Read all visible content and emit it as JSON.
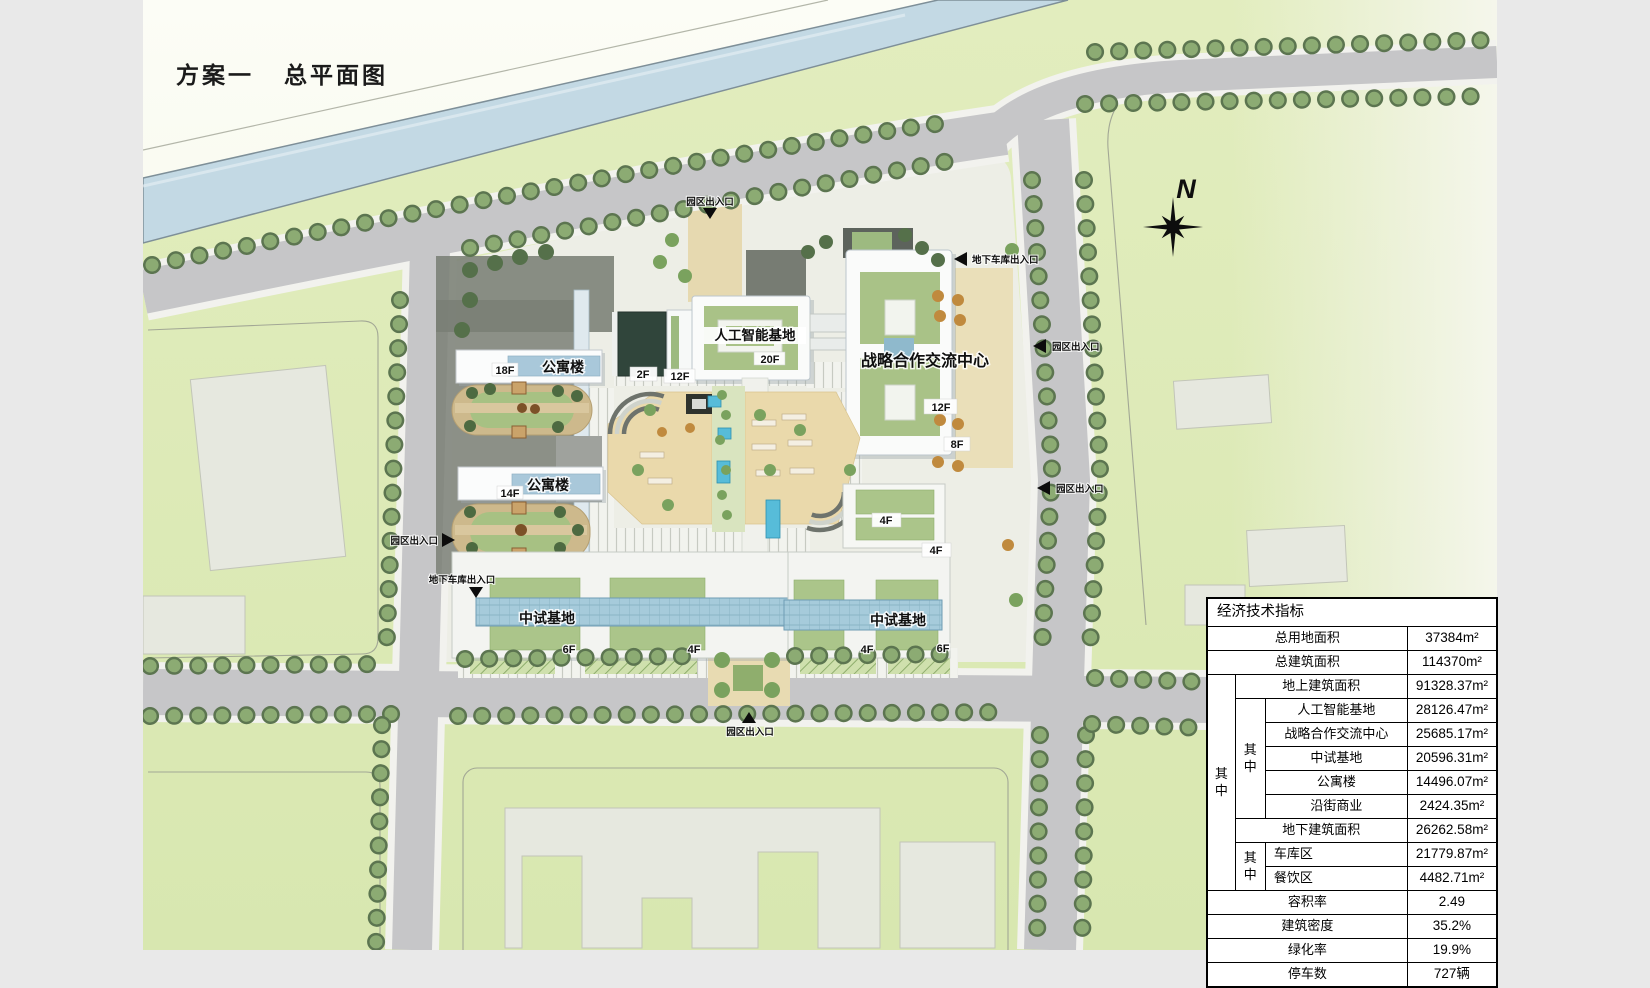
{
  "page": {
    "title1": "方案一",
    "title2": "总平面图"
  },
  "north": {
    "label": "N"
  },
  "plan": {
    "buildings": {
      "apt1": {
        "name": "公寓楼",
        "floors": "18F"
      },
      "apt2": {
        "name": "公寓楼",
        "floors": "14F"
      },
      "podium2f": {
        "floors": "2F"
      },
      "tower12f": {
        "floors": "12F"
      },
      "ai": {
        "name": "人工智能基地",
        "floors": "20F"
      },
      "strategic": {
        "name": "战略合作交流中心",
        "f1": "12F",
        "f2": "8F"
      },
      "b4f": {
        "f1": "4F",
        "f2": "4F"
      },
      "pilot_w": {
        "name": "中试基地",
        "f1": "6F",
        "f2": "4F"
      },
      "pilot_e": {
        "name": "中试基地",
        "f1": "4F",
        "f2": "6F"
      }
    },
    "entrances": {
      "park": "园区出入口",
      "garage": "地下车库出入口"
    }
  },
  "table": {
    "title": "经济技术指标",
    "group_label": "其中",
    "rows": [
      {
        "label": "总用地面积",
        "value": "37384m²"
      },
      {
        "label": "总建筑面积",
        "value": "114370m²"
      },
      {
        "label": "地上建筑面积",
        "value": "91328.37m²"
      },
      {
        "label": "人工智能基地",
        "value": "28126.47m²"
      },
      {
        "label": "战略合作交流中心",
        "value": "25685.17m²"
      },
      {
        "label": "中试基地",
        "value": "20596.31m²"
      },
      {
        "label": "公寓楼",
        "value": "14496.07m²"
      },
      {
        "label": "沿街商业",
        "value": "2424.35m²"
      },
      {
        "label": "地下建筑面积",
        "value": "26262.58m²"
      },
      {
        "label": "车库区",
        "value": "21779.87m²"
      },
      {
        "label": "餐饮区",
        "value": "4482.71m²"
      },
      {
        "label": "容积率",
        "value": "2.49"
      },
      {
        "label": "建筑密度",
        "value": "35.2%"
      },
      {
        "label": "绿化率",
        "value": "19.9%"
      },
      {
        "label": "停车数",
        "value": "727辆"
      }
    ]
  }
}
